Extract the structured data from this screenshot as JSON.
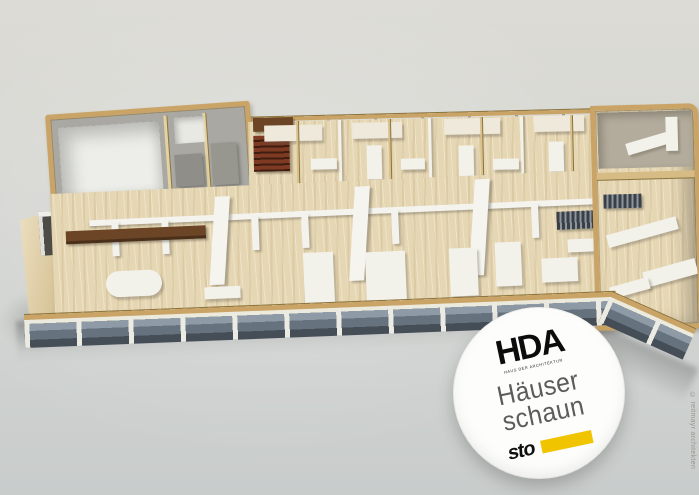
{
  "badge": {
    "org": "HDA",
    "org_subtitle": "HAUS DER ARCHITEKTUR",
    "title_line1": "Häuser",
    "title_line2": "schaun",
    "sponsor": "sto"
  },
  "credit": "© reitmayr architekten",
  "colors": {
    "bg_top": "#dcdbd5",
    "bg_bottom": "#c8cccb",
    "plywood": "#c9a466",
    "plywood_light": "#decb97",
    "plywood_dark": "#8a7440",
    "balsa": "#e6d7b4",
    "balsa_light": "#eee2c4",
    "white_wall": "#f2f1ea",
    "grey_wall": "#a9a8a3",
    "walnut": "#6b4526",
    "mahogany": "#7e3a22",
    "glass_top": "#8e9aa5",
    "glass_dark": "#454e57",
    "mullion": "#ecebe3",
    "sto_yellow": "#f1c400",
    "badge_text": "#5c5c5c",
    "credit_grey": "#98988f"
  }
}
